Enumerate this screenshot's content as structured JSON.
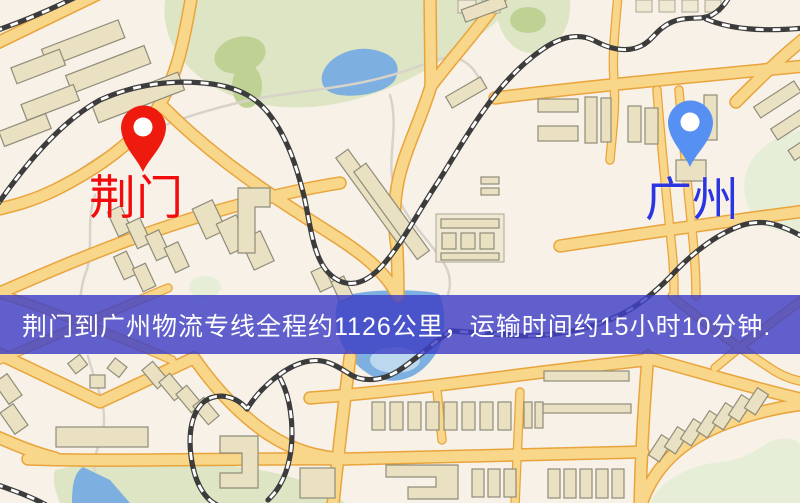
{
  "map": {
    "origin": {
      "label": "荆门",
      "pin_color": "#ee1a0e",
      "label_color": "#f20c0c"
    },
    "destination": {
      "label": "广州",
      "pin_color": "#5590f2",
      "label_color": "#2b35e0"
    },
    "banner": {
      "text": "荆门到广州物流专线全程约1126公里，运输时间约15小时10分钟.",
      "background": "rgba(62,62,197,0.82)",
      "text_color": "#ffffff"
    },
    "colors": {
      "land": "#f8f1e8",
      "road": "#f8d68a",
      "road_casing": "#e9a43c",
      "water": "#7db0e0",
      "park": "#dde5c4",
      "building": "#eae0c2",
      "railway": "#3c3c3c"
    }
  }
}
